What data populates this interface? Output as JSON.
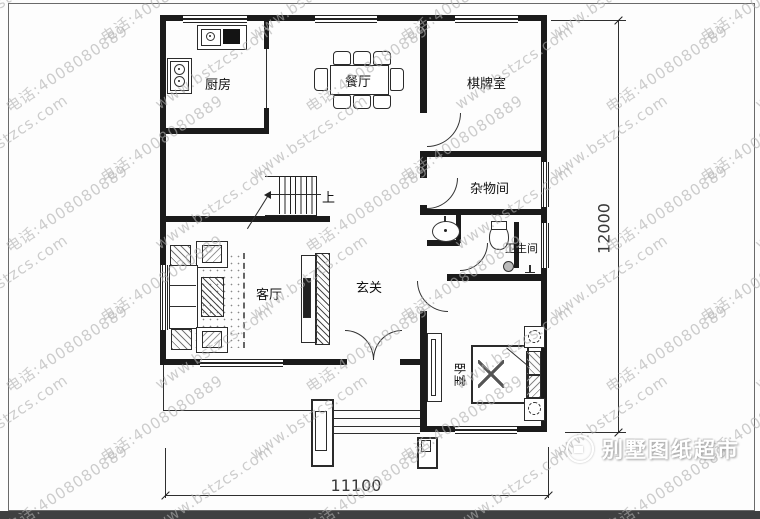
{
  "watermark": {
    "site": "www.bstzcs.com",
    "phone": "电话:4008080889"
  },
  "rooms": {
    "kitchen": "厨房",
    "dining": "餐厅",
    "mahjong": "棋牌室",
    "storage": "杂物间",
    "bathroom": "卫生间",
    "living": "客厅",
    "foyer": "玄关",
    "bedroom": "卧室"
  },
  "stairs": {
    "up_label": "上"
  },
  "dimensions": {
    "width": "11100",
    "height": "12000"
  },
  "brand": {
    "logo_text": "别墅图纸超市"
  }
}
